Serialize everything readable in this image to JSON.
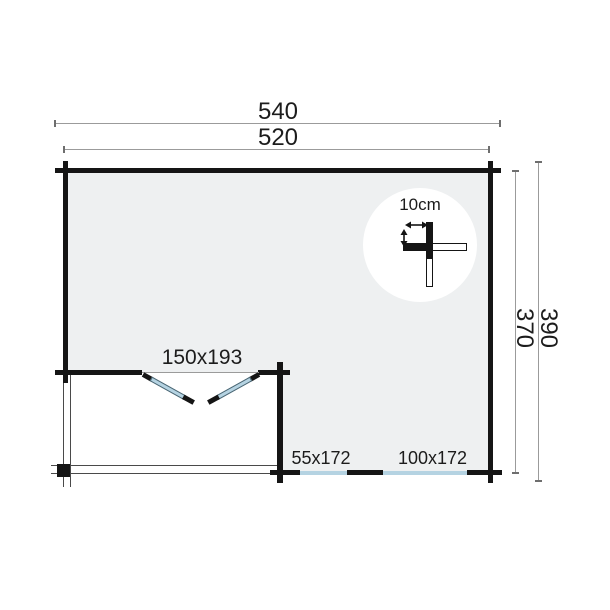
{
  "colors": {
    "bg": "#ffffff",
    "wall": "#151515",
    "floor": "#eef0f1",
    "glass": "#b5d3e2",
    "dim_line": "#9b9b9b",
    "dim_tick": "#6e6e6e",
    "thin_line": "#4a4a4a",
    "text": "#1c1c1c"
  },
  "dimensions": {
    "top_outer": "540",
    "top_inner": "520",
    "right_outer": "390",
    "right_inner": "370"
  },
  "door": {
    "label": "150x193"
  },
  "windows": [
    {
      "label": "55x172"
    },
    {
      "label": "100x172"
    }
  ],
  "wall_detail": {
    "label": "10cm",
    "icon": "log-corner-cross"
  }
}
